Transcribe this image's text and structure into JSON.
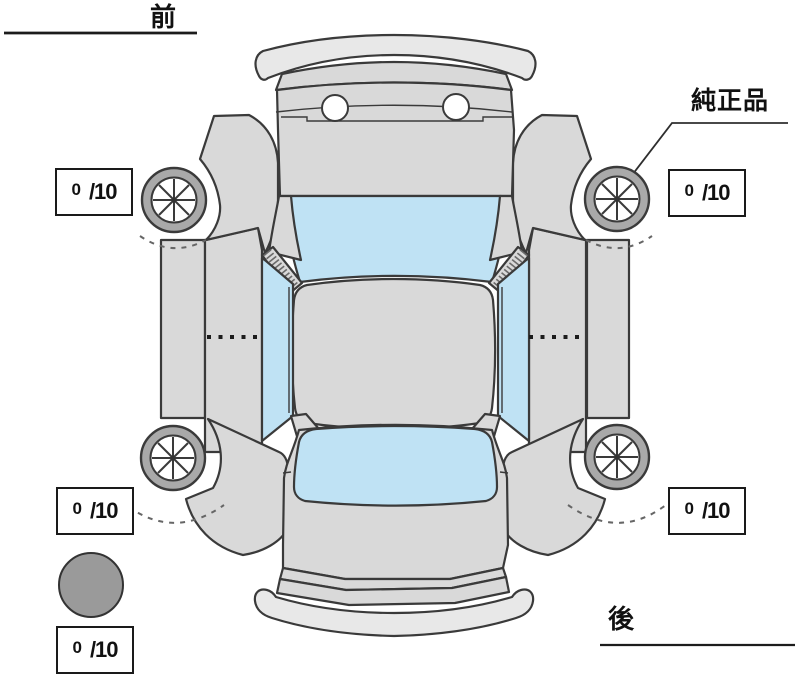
{
  "labels": {
    "front": "前",
    "rear": "後",
    "genuine_part": "純正品"
  },
  "tread_boxes": [
    {
      "position": "front-left",
      "numerator": "0",
      "fraction": "/10"
    },
    {
      "position": "front-right",
      "numerator": "0",
      "fraction": "/10"
    },
    {
      "position": "rear-left",
      "numerator": "0",
      "fraction": "/10"
    },
    {
      "position": "rear-right",
      "numerator": "0",
      "fraction": "/10"
    },
    {
      "position": "spare",
      "numerator": "0",
      "fraction": "/10"
    }
  ],
  "colors": {
    "body": "#d9d9d9",
    "glass": "#bfe2f4",
    "tire": "#a9a9a9",
    "bumper": "#e8e8e8",
    "marker": "#9a9a9a",
    "line": "#3a3a3a",
    "text": "#111111"
  }
}
